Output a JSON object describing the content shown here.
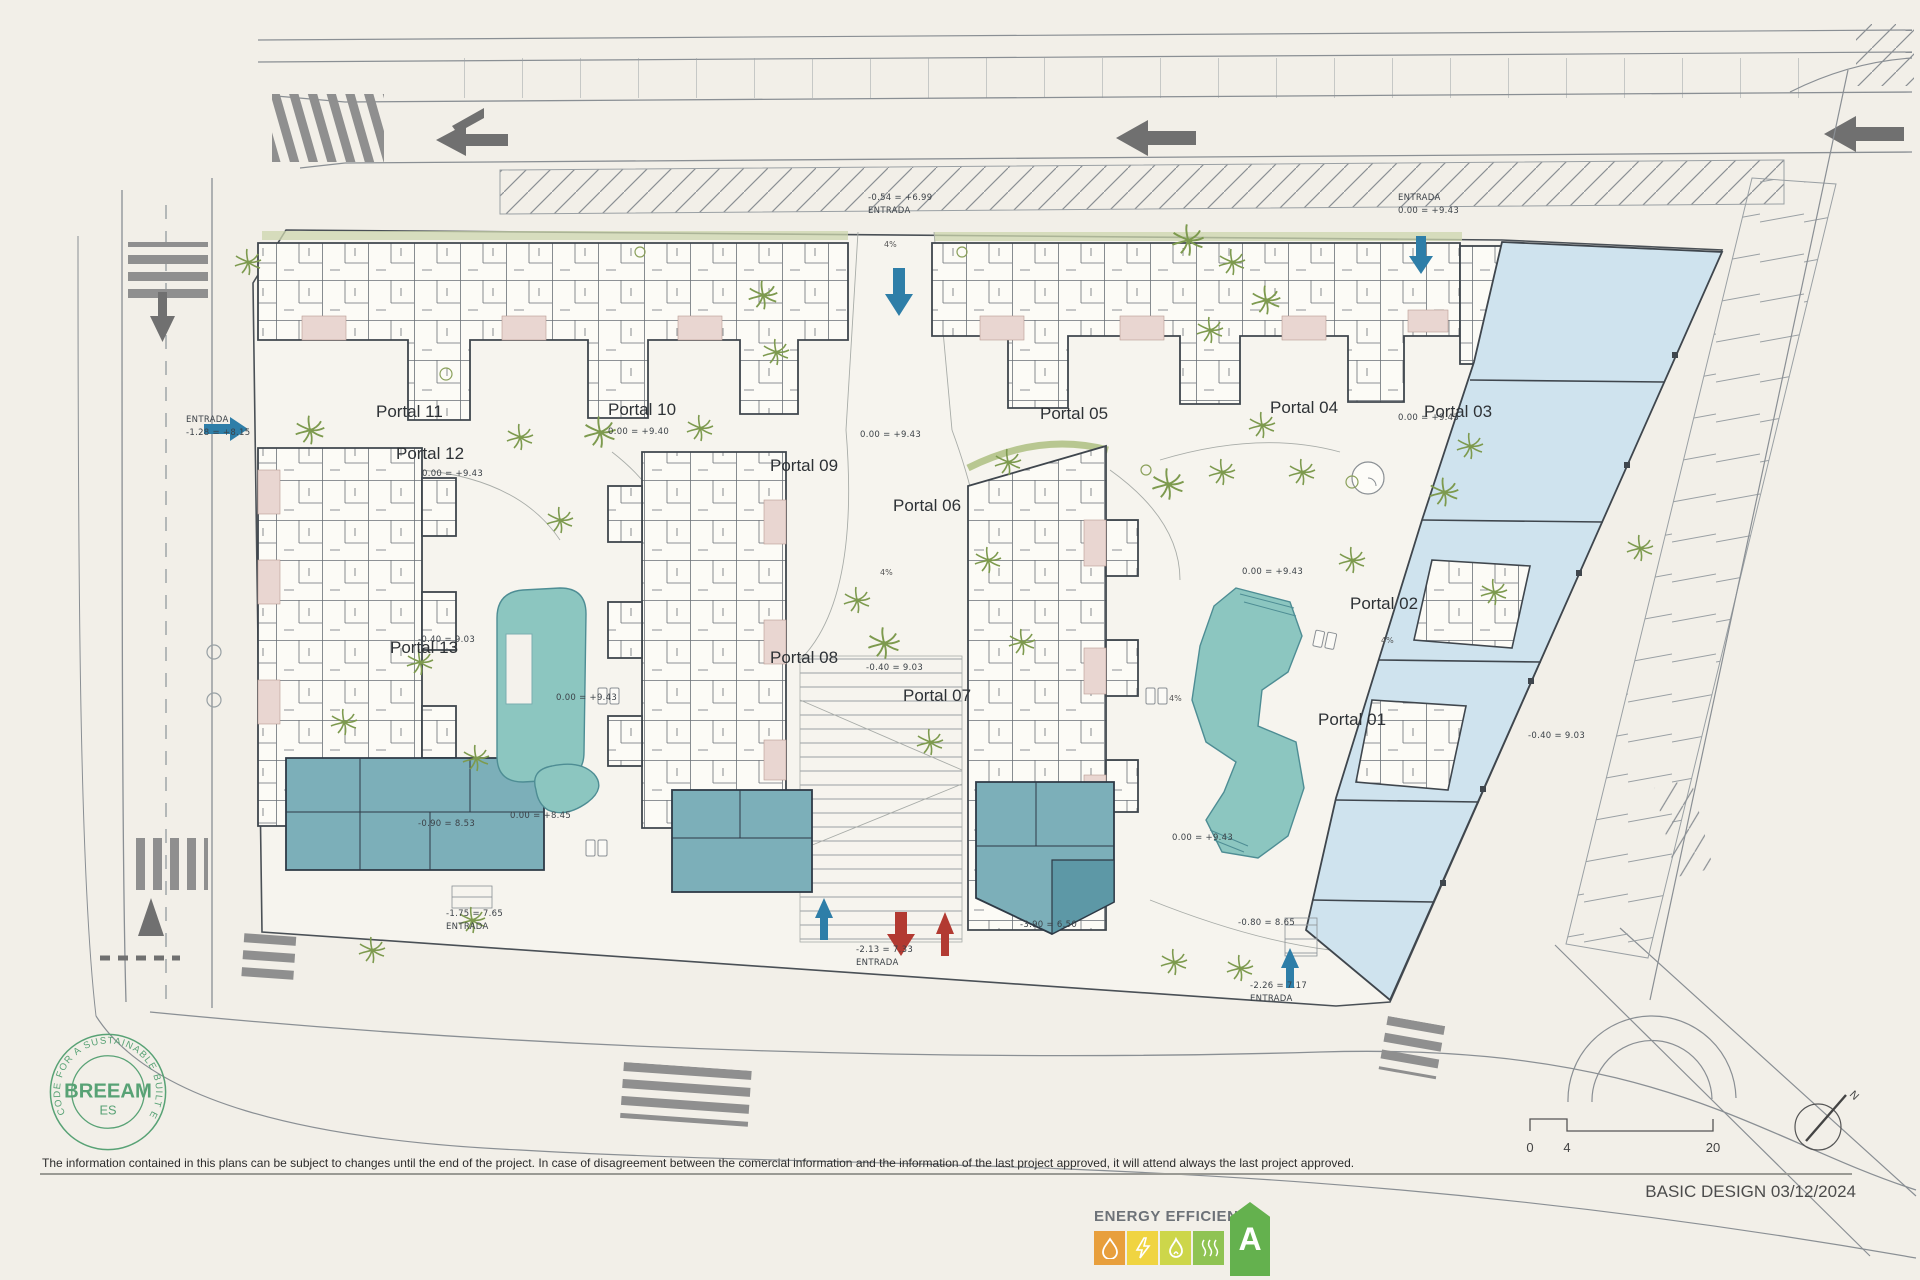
{
  "colors": {
    "paper": "#f2efe8",
    "plot_fill": "#f6f4ee",
    "line_dark": "#3f464d",
    "line_mid": "#8a8f94",
    "pool_teal": "#8cc6c0",
    "commercial_blue": "#cfe3ee",
    "amenity_teal": "#7cafb9",
    "terrace_pink": "#e9d6d1",
    "vegetation_green": "#7d9a4e",
    "road_gray": "#8f8f8f",
    "arrow_blue": "#2e7ea8",
    "arrow_red": "#b23a32",
    "breeam_green": "#58a275",
    "energy_orange": "#e89f3c",
    "energy_yellow": "#f0d441",
    "energy_lime": "#cdd64a",
    "energy_green": "#8fc353",
    "energy_a_green": "#64b14e"
  },
  "plan": {
    "portals": [
      "Portal 01",
      "Portal 02",
      "Portal 03",
      "Portal 04",
      "Portal 05",
      "Portal 06",
      "Portal 07",
      "Portal 08",
      "Portal 09",
      "Portal 10",
      "Portal 11",
      "Portal 12",
      "Portal 13"
    ],
    "elevations": [
      {
        "a": "-0.54 = +6.99",
        "b": "ENTRADA"
      },
      {
        "a": "ENTRADA",
        "b": "0.00 = +9.43"
      },
      {
        "a": "ENTRADA",
        "b": "-1.28 = +8.15"
      },
      {
        "a": "0.00 = +9.40"
      },
      {
        "a": "0.00 = +9.43"
      },
      {
        "a": "0.00 = +9.43"
      },
      {
        "a": "0.00 = +9.43"
      },
      {
        "a": "0.00 = +9.43"
      },
      {
        "a": "0.00 = +8.45"
      },
      {
        "a": "-0.40 = 9.03"
      },
      {
        "a": "-0.90 = 8.53"
      },
      {
        "a": "-0.40 = 9.03"
      },
      {
        "a": "0.00 = +9.43"
      },
      {
        "a": "0.00 = +9.43"
      },
      {
        "a": "-3.90 = 6.50"
      },
      {
        "a": "-1.75 = 7.65",
        "b": "ENTRADA"
      },
      {
        "a": "-2.13 = 7.33",
        "b": "ENTRADA"
      },
      {
        "a": "-2.26 = 7.17",
        "b": "ENTRADA"
      },
      {
        "a": "-0.80 = 8.65"
      },
      {
        "a": "-0.40 = 9.03"
      }
    ],
    "slopes": [
      "4%",
      "4%",
      "4%",
      "4%"
    ]
  },
  "legend": {
    "scale": {
      "t0": "0",
      "t1": "4",
      "t2": "20"
    },
    "north": "N",
    "breeam": {
      "ring": "CODE FOR A SUSTAINABLE BUILT ENVIRONMENT",
      "name": "BREEAM",
      "region": "ES"
    },
    "energy": {
      "title": "ENERGY EFFICIENCY",
      "rating": "A"
    }
  },
  "footer": {
    "disclaimer": "The information contained in this plans can be subject to changes until the end of the project. In case of disagreement between the comercial information and the information of the last project approved, it will attend always the last project approved.",
    "stamp": "BASIC DESIGN 03/12/2024"
  }
}
